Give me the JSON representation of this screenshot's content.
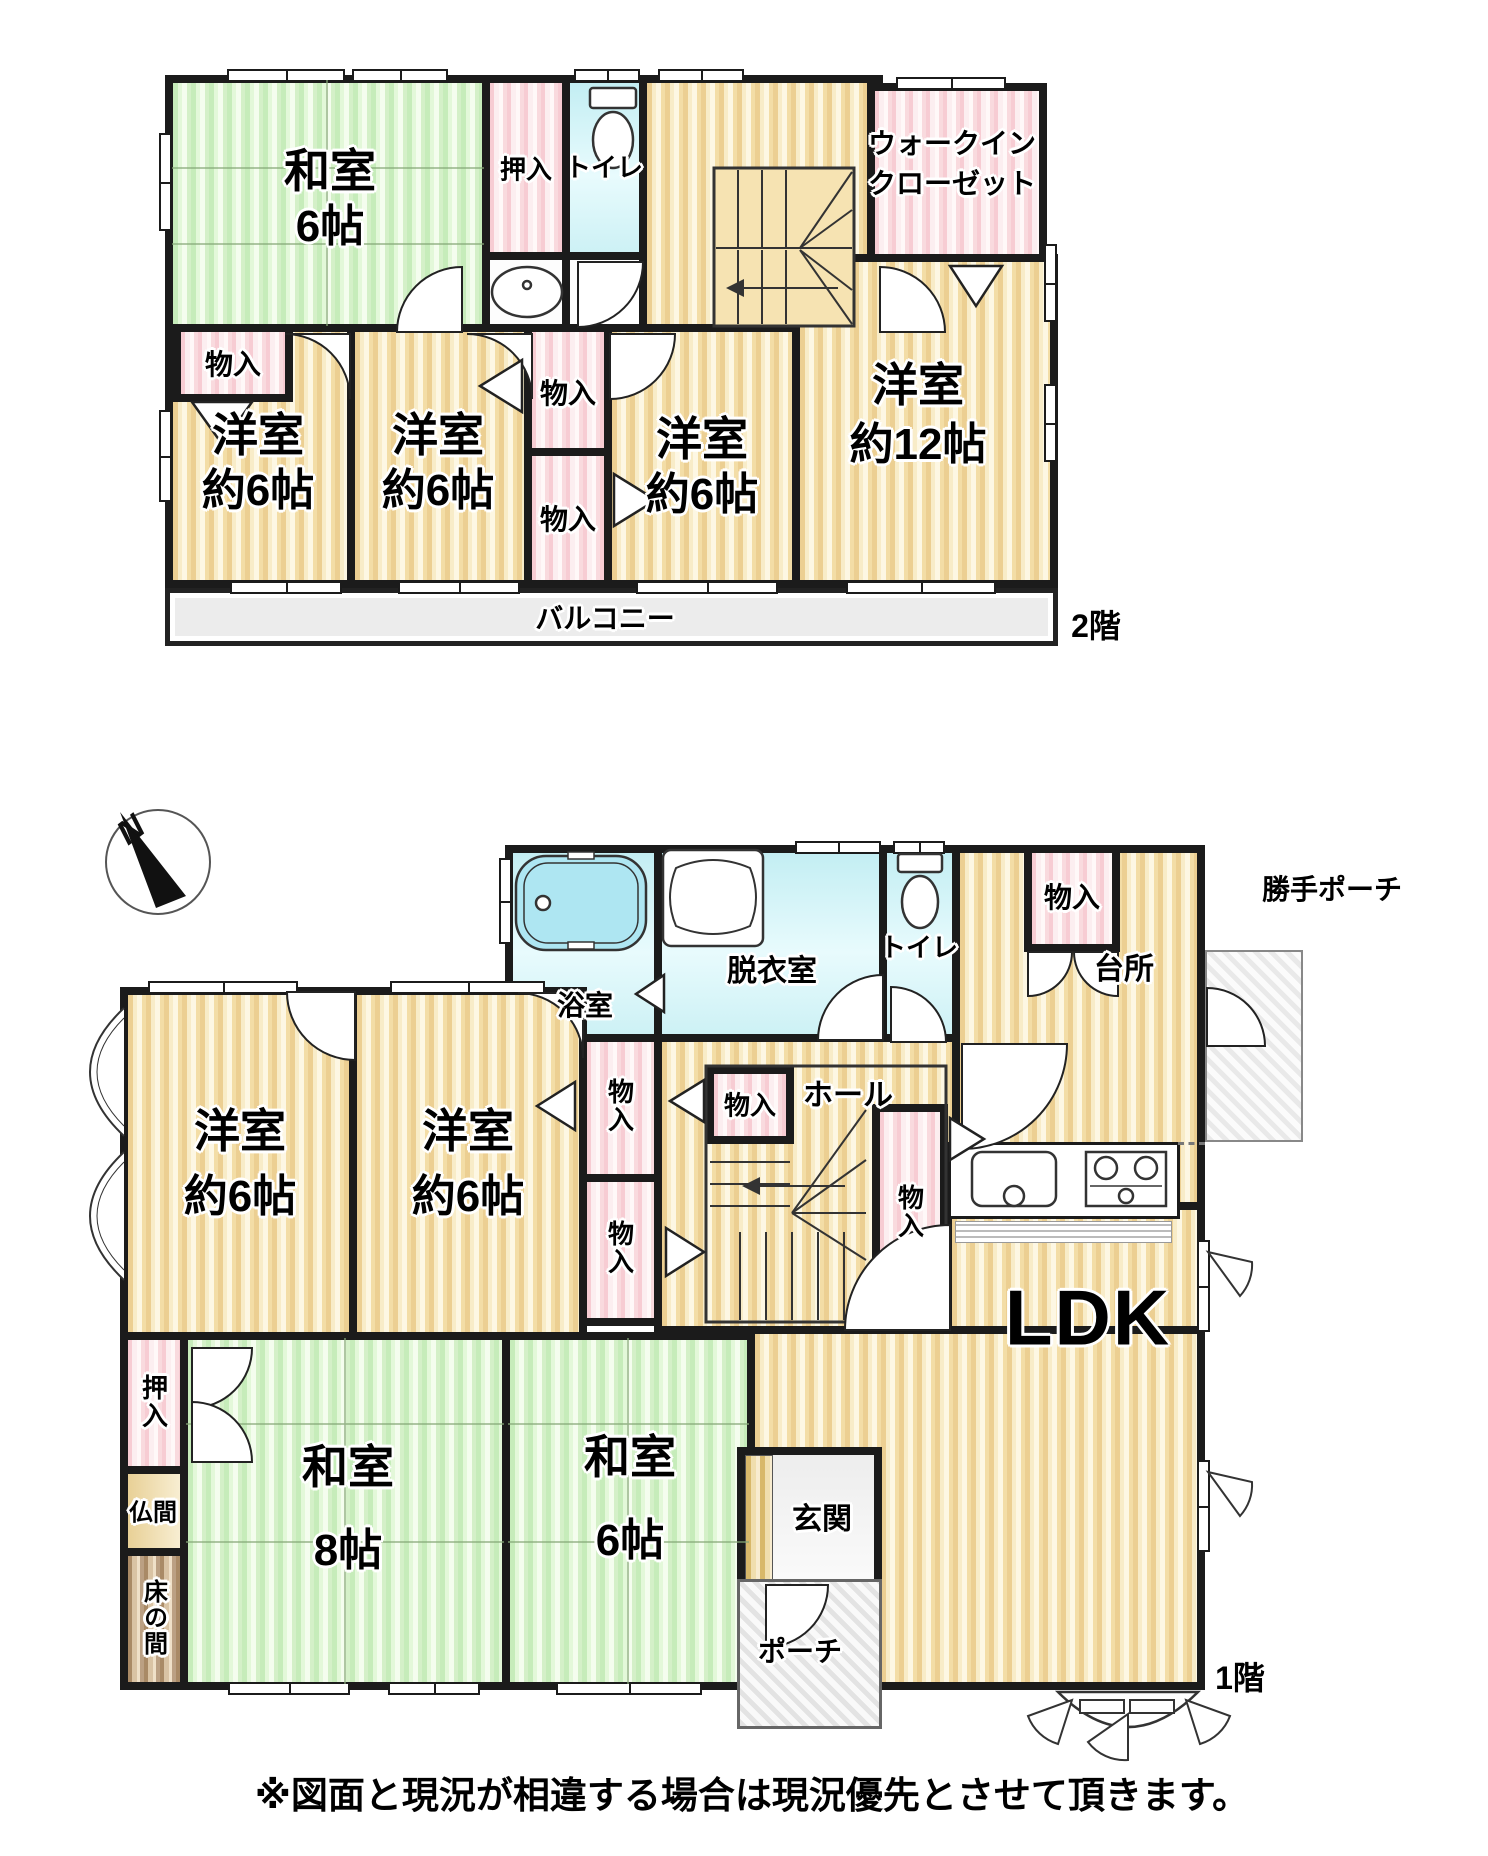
{
  "floors": {
    "f2": {
      "floor_label": "2階",
      "rooms": {
        "washitsu6": {
          "name": "和室",
          "size": "6帖"
        },
        "oshiire": {
          "name": "押入"
        },
        "toilet": {
          "name": "トイレ"
        },
        "wic": {
          "name": "ウォークイン",
          "name2": "クローゼット"
        },
        "mono_left": {
          "name": "物入"
        },
        "mono_mid_top": {
          "name": "物入"
        },
        "mono_mid_bottom": {
          "name": "物入"
        },
        "yoshitsu_a": {
          "name": "洋室",
          "size": "約6帖"
        },
        "yoshitsu_b": {
          "name": "洋室",
          "size": "約6帖"
        },
        "yoshitsu_c": {
          "name": "洋室",
          "size": "約6帖"
        },
        "yoshitsu_12": {
          "name": "洋室",
          "size": "約12帖"
        },
        "balcony": {
          "name": "バルコニー"
        }
      }
    },
    "f1": {
      "floor_label": "1階",
      "rooms": {
        "bath": {
          "name": "浴室"
        },
        "datsuishitsu": {
          "name": "脱衣室"
        },
        "toilet": {
          "name": "トイレ"
        },
        "mono_kitchen": {
          "name": "物入"
        },
        "kitchen": {
          "name": "台所"
        },
        "katte_porch": {
          "name": "勝手ポーチ"
        },
        "hall": {
          "name": "ホール"
        },
        "mono_corridor_top": {
          "name": "物入"
        },
        "mono_corridor_bottom": {
          "name": "物入"
        },
        "mono_stairs_left": {
          "name": "物入"
        },
        "mono_stairs_right": {
          "name": "物入"
        },
        "yoshitsu_a": {
          "name": "洋室",
          "size": "約6帖"
        },
        "yoshitsu_b": {
          "name": "洋室",
          "size": "約6帖"
        },
        "ldk": {
          "name": "LDK"
        },
        "washitsu8": {
          "name": "和室",
          "size": "8帖"
        },
        "washitsu6": {
          "name": "和室",
          "size": "6帖"
        },
        "oshiire": {
          "name": "押入"
        },
        "butsuma": {
          "name": "仏間"
        },
        "tokonoma": {
          "name": "床の間"
        },
        "genkan": {
          "name": "玄関"
        },
        "porch": {
          "name": "ポーチ"
        }
      }
    }
  },
  "compass": {
    "north_label": "N"
  },
  "disclaimer": "※図面と現況が相違する場合は現況優先とさせて頂きます。",
  "colors": {
    "wall": "#1b1b1b",
    "wood": "#f3dda6",
    "tatami": "#cfeec2",
    "closet_pink": "#f8d7dc",
    "bath_cyan": "#cdf0f4"
  }
}
